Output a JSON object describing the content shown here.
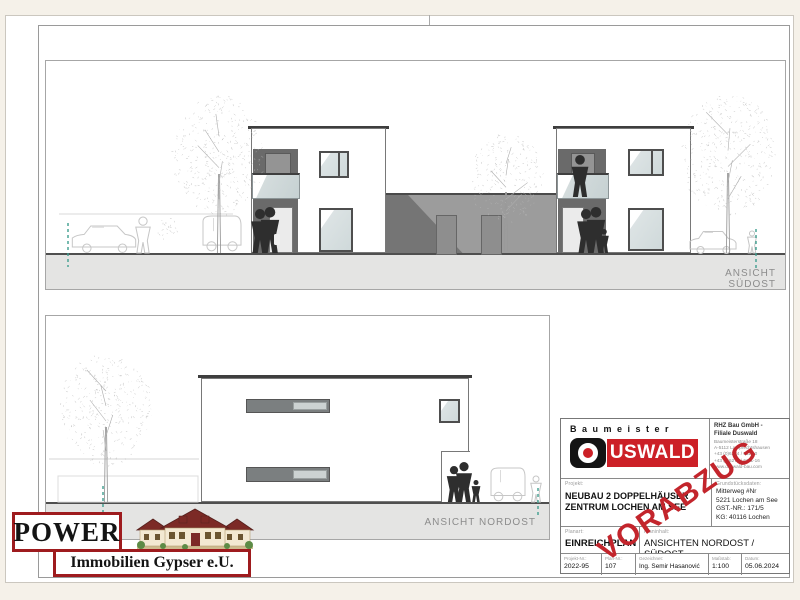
{
  "panels": {
    "suedost": {
      "label": "ANSICHT SÜDOST"
    },
    "nordost": {
      "label": "ANSICHT NORDOST"
    }
  },
  "watermark": {
    "text": "VORABZUG",
    "color": "#c3252c"
  },
  "power_logo": {
    "title": "POWER",
    "subtitle": "Immobilien Gypser e.U.",
    "border_color": "#9e1b1e",
    "icon": "villa-illustration"
  },
  "title_block": {
    "brand_word": "Baumeister",
    "brand_logo": {
      "text": "USWALD",
      "red": "#cc2027"
    },
    "company": {
      "line1": "RHZ Bau GmbH -",
      "line2": "Filiale Duswald",
      "details": [
        "Baumeisterstraße 18",
        "A-5112 Lamprechtshausen",
        "+43 (0)6274 / 6111-0",
        "+43 (0)6274 / 6111-16",
        "www.duswald-bau.com"
      ]
    },
    "project": {
      "label": "Projekt:",
      "line1": "NEUBAU 2 DOPPELHÄUSER",
      "line2": "ZENTRUM LOCHEN AM SEE"
    },
    "site": {
      "label": "Grundstücksdaten:",
      "lines": [
        "Mitterweg #Nr",
        "5221 Lochen am See",
        "GST.-NR.: 171/5",
        "KG: 40116 Lochen"
      ]
    },
    "plan_type": {
      "label": "Planart:",
      "value": "EINREICHPLAN"
    },
    "plan_content": {
      "label": "Planinhalt:",
      "value": "ANSICHTEN NORDOST / SÜDOST"
    },
    "fields": [
      {
        "label": "Projekt-Nr.:",
        "value": "2022-95"
      },
      {
        "label": "Plan-Nr.:",
        "value": "107"
      },
      {
        "label": "Gezeichnet:",
        "value": "Ing. Semir Hasanović"
      },
      {
        "label": "Maßstab:",
        "value": "1:100"
      },
      {
        "label": "Datum:",
        "value": "05.06.2024"
      }
    ]
  }
}
